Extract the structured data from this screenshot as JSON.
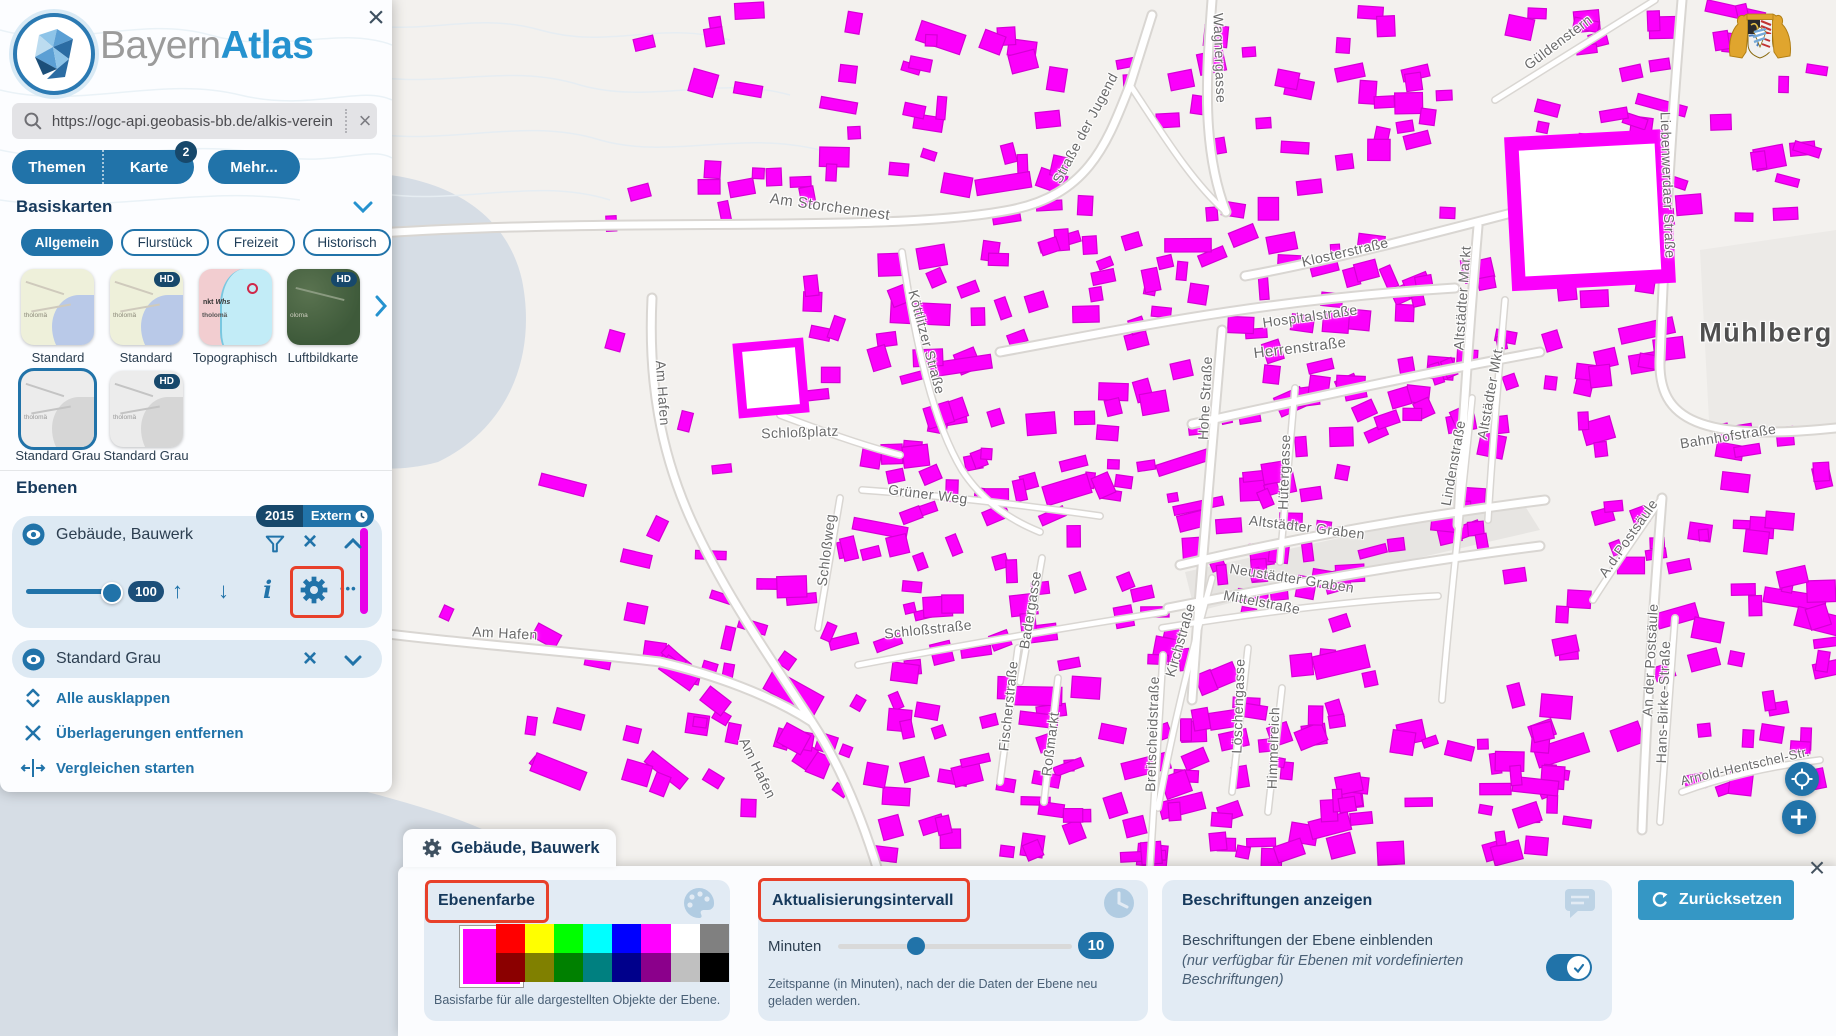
{
  "colors": {
    "accent": "#2173a9",
    "navy": "#17486b",
    "building": "#fb00fb",
    "highlight": "#e8402a",
    "card_bg": "#dde9f3",
    "panel_card_bg": "#e2ebf4",
    "reset_btn": "#3597c5",
    "water": "#d6dde5"
  },
  "icons": {
    "close": "×",
    "clear": "×",
    "up": "↑",
    "down": "↓",
    "info": "i",
    "more": "•••"
  },
  "header": {
    "brand_gray": "Bayern",
    "brand_blue": "Atlas"
  },
  "search": {
    "value": "https://ogc-api.geobasis-bb.de/alkis-verein"
  },
  "tabs": {
    "themen": "Themen",
    "karte": "Karte",
    "karte_badge": "2",
    "mehr": "Mehr..."
  },
  "basiskarten": {
    "title": "Basiskarten",
    "hd_badge": "HD",
    "chips": [
      "Allgemein",
      "Flurstück",
      "Freizeit",
      "Historisch"
    ],
    "maps": [
      {
        "label": "Standard"
      },
      {
        "label": "Standard"
      },
      {
        "label": "Topographisch"
      },
      {
        "label": "Luftbildkarte"
      },
      {
        "label": "Standard Grau"
      },
      {
        "label": "Standard Grau"
      }
    ]
  },
  "ebenen": {
    "title": "Ebenen",
    "layer1": {
      "name": "Gebäude, Bauwerk",
      "badge_year": "2015",
      "badge_extern": "Extern",
      "opacity": "100"
    },
    "layer2": {
      "name": "Standard Grau"
    },
    "links": [
      "Alle ausklappen",
      "Überlagerungen entfernen",
      "Vergleichen starten"
    ]
  },
  "panel": {
    "tab_title": "Gebäude, Bauwerk",
    "ebenenfarbe": {
      "title": "Ebenenfarbe",
      "current": "#ff00ff",
      "palette": [
        "#ff0000",
        "#ffff00",
        "#00ff00",
        "#00ffff",
        "#0000ff",
        "#ff00ff",
        "#ffffff",
        "#808080",
        "#8b0000",
        "#808000",
        "#008000",
        "#008080",
        "#00008b",
        "#8b008b",
        "#c0c0c0",
        "#000000"
      ],
      "caption": "Basisfarbe für alle dargestellten Objekte der Ebene."
    },
    "interval": {
      "title": "Aktualisierungsintervall",
      "label": "Minuten",
      "value": "10",
      "caption": "Zeitspanne (in Minuten), nach der die Daten der Ebene neu geladen werden."
    },
    "labels_section": {
      "title": "Beschriftungen anzeigen",
      "line1": "Beschriftungen der Ebene einblenden",
      "line2": "(nur verfügbar für Ebenen mit vordefinierten Beschriftungen)",
      "toggle_on": true
    },
    "reset_label": "Zurücksetzen"
  },
  "map": {
    "street_labels": [
      {
        "t": "Am Storchennest",
        "x": 830,
        "y": 207,
        "r": 8,
        "s": 15
      },
      {
        "t": "Straße der Jugend",
        "x": 1085,
        "y": 128,
        "r": -62,
        "s": 14
      },
      {
        "t": "Wagnergasse",
        "x": 1220,
        "y": 58,
        "r": 88,
        "s": 14
      },
      {
        "t": "Güldenstern",
        "x": 1558,
        "y": 42,
        "r": -37,
        "s": 14
      },
      {
        "t": "Liebenwerdaer Straße",
        "x": 1668,
        "y": 185,
        "r": 88,
        "s": 14
      },
      {
        "t": "Klosterstraße",
        "x": 1345,
        "y": 252,
        "r": -13,
        "s": 14
      },
      {
        "t": "Hospitalstraße",
        "x": 1310,
        "y": 316,
        "r": -8,
        "s": 14
      },
      {
        "t": "Altstädter Markt",
        "x": 1462,
        "y": 298,
        "r": -86,
        "s": 14
      },
      {
        "t": "Altstädter Mkt.",
        "x": 1490,
        "y": 392,
        "r": -80,
        "s": 14
      },
      {
        "t": "Herrenstraße",
        "x": 1300,
        "y": 348,
        "r": -7,
        "s": 15
      },
      {
        "t": "Köttlitzer Straße",
        "x": 927,
        "y": 342,
        "r": 75,
        "s": 14
      },
      {
        "t": "Hohe Straße",
        "x": 1205,
        "y": 398,
        "r": -87,
        "s": 14
      },
      {
        "t": "Hütergasse",
        "x": 1284,
        "y": 472,
        "r": -88,
        "s": 14
      },
      {
        "t": "Mühlberg",
        "x": 1766,
        "y": 333,
        "r": 0,
        "s": 27,
        "c": "#4f4f4f",
        "w": "600",
        "ls": 1.5
      },
      {
        "t": "Bahnhofstraße",
        "x": 1728,
        "y": 436,
        "r": -9,
        "s": 14
      },
      {
        "t": "Lindenstraße",
        "x": 1453,
        "y": 463,
        "r": -80,
        "s": 14
      },
      {
        "t": "Schloßplatz",
        "x": 800,
        "y": 432,
        "r": -2,
        "s": 14
      },
      {
        "t": "Am Hafen",
        "x": 663,
        "y": 393,
        "r": 86,
        "s": 14
      },
      {
        "t": "Grüner Weg",
        "x": 928,
        "y": 494,
        "r": 7,
        "s": 14
      },
      {
        "t": "Schloßweg",
        "x": 826,
        "y": 550,
        "r": -83,
        "s": 14
      },
      {
        "t": "Altstädter Graben",
        "x": 1307,
        "y": 527,
        "r": 7,
        "s": 14
      },
      {
        "t": "Neustädter Graben",
        "x": 1292,
        "y": 578,
        "r": 9,
        "s": 14
      },
      {
        "t": "Mittelstraße",
        "x": 1262,
        "y": 602,
        "r": 11,
        "s": 14
      },
      {
        "t": "A.d.Postsäule",
        "x": 1628,
        "y": 538,
        "r": -55,
        "s": 14
      },
      {
        "t": "An der Postsäule",
        "x": 1650,
        "y": 660,
        "r": -87,
        "s": 14
      },
      {
        "t": "Schloßstraße",
        "x": 928,
        "y": 629,
        "r": -6,
        "s": 14
      },
      {
        "t": "Kirchstraße",
        "x": 1180,
        "y": 640,
        "r": -74,
        "s": 14
      },
      {
        "t": "Badergasse",
        "x": 1030,
        "y": 610,
        "r": -81,
        "s": 14
      },
      {
        "t": "Fischerstraße",
        "x": 1008,
        "y": 706,
        "r": -84,
        "s": 14
      },
      {
        "t": "Roßmarkt",
        "x": 1050,
        "y": 744,
        "r": -83,
        "s": 14
      },
      {
        "t": "Breitscheidstraße",
        "x": 1152,
        "y": 734,
        "r": -88,
        "s": 14
      },
      {
        "t": "Löschengasse",
        "x": 1238,
        "y": 706,
        "r": -88,
        "s": 14
      },
      {
        "t": "Himmelreich",
        "x": 1273,
        "y": 748,
        "r": -88,
        "s": 14
      },
      {
        "t": "Hans-Birke-Straße",
        "x": 1663,
        "y": 702,
        "r": -88,
        "s": 14
      },
      {
        "t": "Arnold-Hentschel-Str.",
        "x": 1745,
        "y": 766,
        "r": -13,
        "s": 13
      },
      {
        "t": "Am Hafen",
        "x": 505,
        "y": 633,
        "r": 3,
        "s": 14
      },
      {
        "t": "Am Hafen",
        "x": 758,
        "y": 768,
        "r": 64,
        "s": 14
      }
    ],
    "buildings": {
      "fill": "#fb00fb",
      "stroke": "#d400d4",
      "seed": 1337,
      "clusters": [
        [
          630,
          5,
          840,
          215,
          75,
          3
        ],
        [
          870,
          235,
          610,
          320,
          160,
          -7
        ],
        [
          870,
          560,
          500,
          300,
          110,
          -5
        ],
        [
          1490,
          5,
          330,
          215,
          48,
          2
        ],
        [
          1480,
          430,
          350,
          370,
          55,
          -4
        ],
        [
          560,
          170,
          290,
          510,
          26,
          2
        ],
        [
          440,
          470,
          390,
          330,
          22,
          25
        ],
        [
          1700,
          450,
          130,
          330,
          16,
          0
        ],
        [
          620,
          620,
          240,
          200,
          18,
          20
        ],
        [
          1160,
          700,
          420,
          160,
          40,
          -3
        ],
        [
          1480,
          230,
          190,
          200,
          28,
          -3
        ]
      ]
    }
  }
}
